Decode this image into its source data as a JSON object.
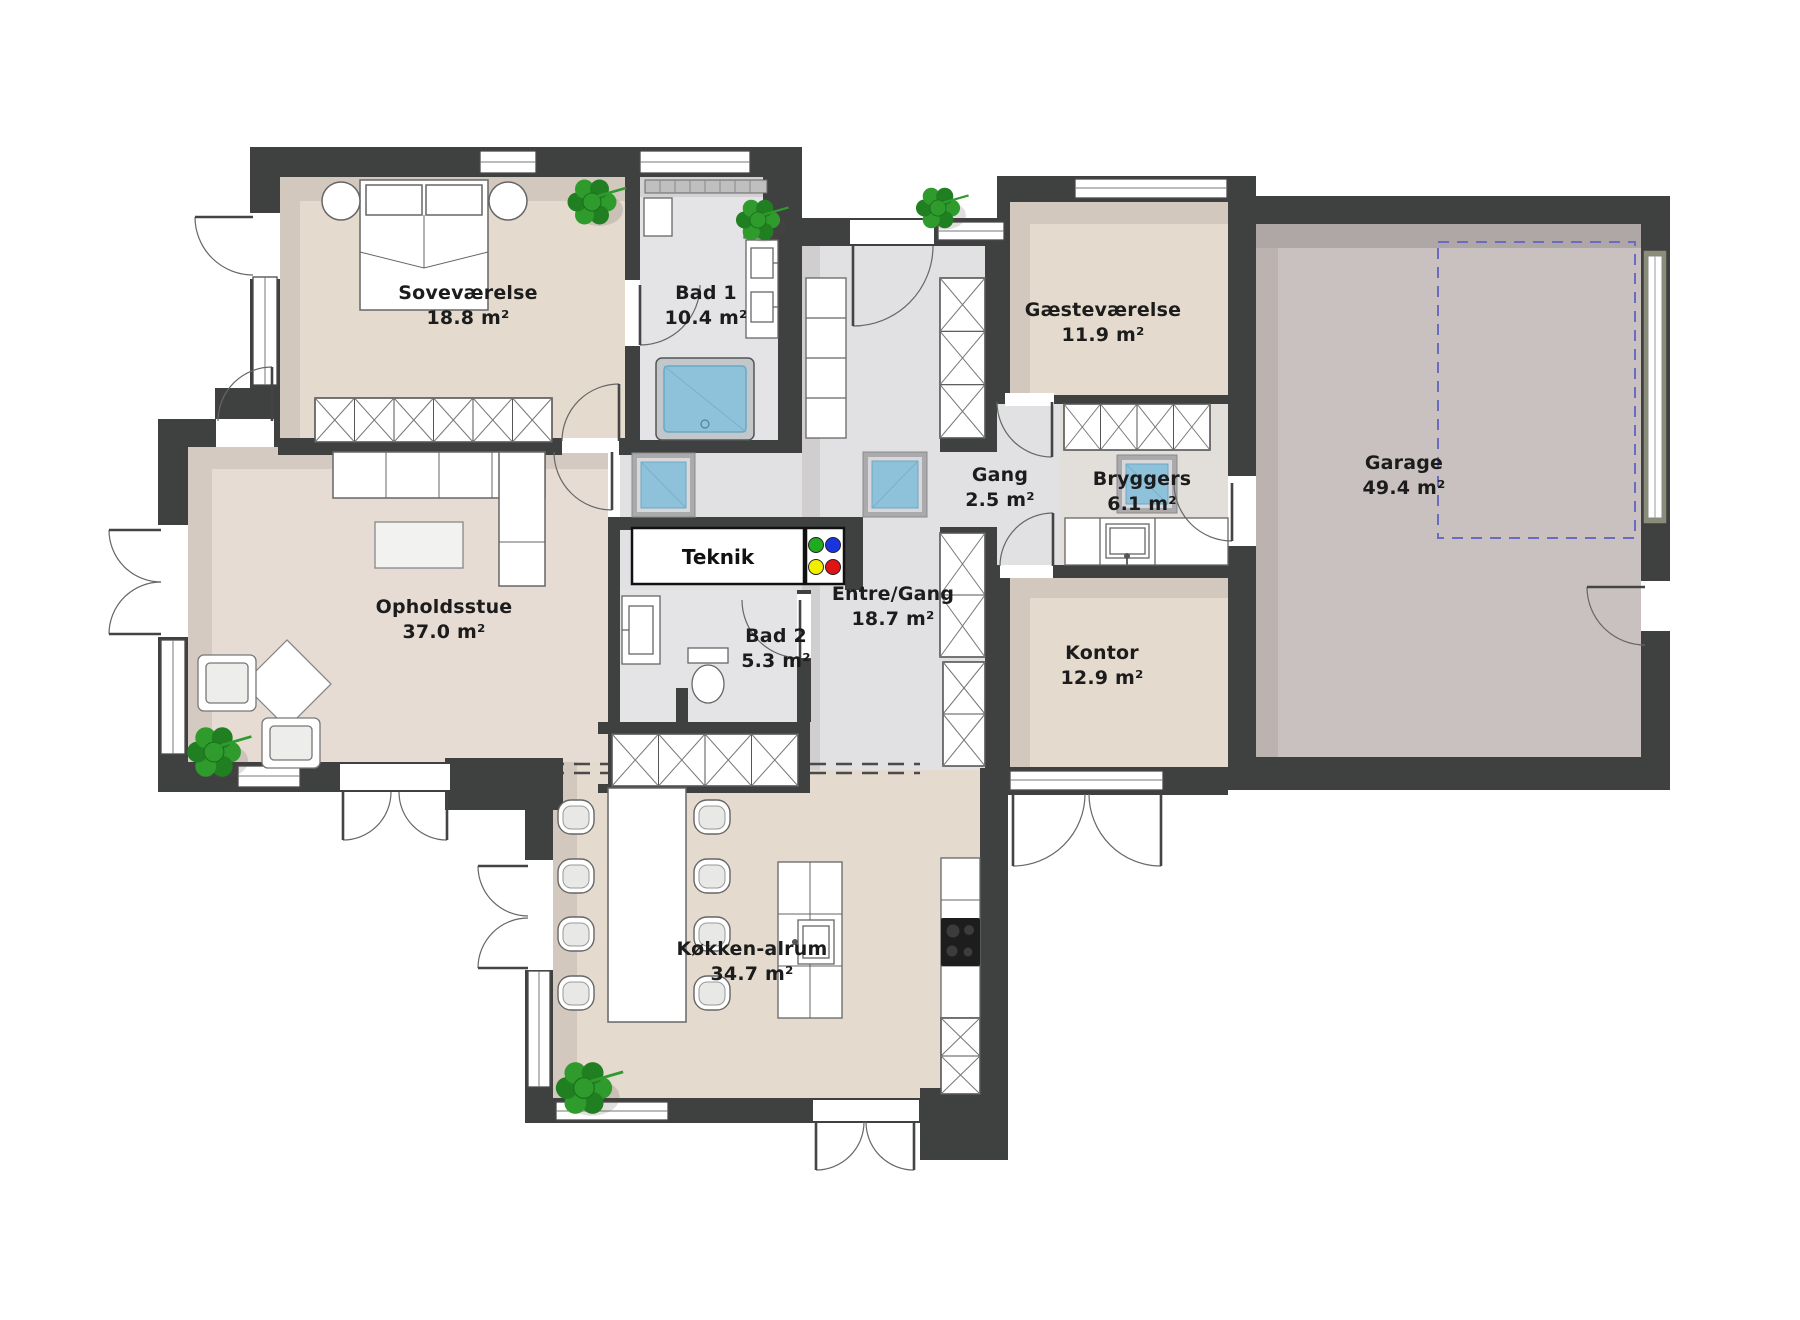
{
  "plan": {
    "title": "Floor plan",
    "rooms": [
      {
        "id": "sovevaerelse",
        "name": "Soveværelse",
        "area": "18.8 m²"
      },
      {
        "id": "bad1",
        "name": "Bad 1",
        "area": "10.4 m²"
      },
      {
        "id": "gaestevaerelse",
        "name": "Gæsteværelse",
        "area": "11.9 m²"
      },
      {
        "id": "gang",
        "name": "Gang",
        "area": "2.5 m²"
      },
      {
        "id": "bryggers",
        "name": "Bryggers",
        "area": "6.1 m²"
      },
      {
        "id": "garage",
        "name": "Garage",
        "area": "49.4 m²"
      },
      {
        "id": "opholdsstue",
        "name": "Opholdsstue",
        "area": "37.0 m²"
      },
      {
        "id": "teknik",
        "name": "Teknik",
        "area": ""
      },
      {
        "id": "bad2",
        "name": "Bad 2",
        "area": "5.3 m²"
      },
      {
        "id": "entre",
        "name": "Entre/Gang",
        "area": "18.7 m²"
      },
      {
        "id": "kontor",
        "name": "Kontor",
        "area": "12.9 m²"
      },
      {
        "id": "koekken",
        "name": "Køkken-alrum",
        "area": "34.7 m²"
      }
    ],
    "colors": {
      "wall": "#3f4040",
      "floor_beige": "#e4dace",
      "floor_living": "#e6dcd3",
      "floor_gray": "#e1e1e3",
      "floor_bath": "#e4e4e6",
      "floor_bryggers": "#e2dfda",
      "floor_garage": "#c9c1c0",
      "skylight_blue": "#8ec2db",
      "plant_green": "#2e9b2c",
      "garage_zone_dashed": "#6b6bc0",
      "teknik_dots": [
        "#1faa1f",
        "#1a35e0",
        "#f2ee00",
        "#e01414"
      ]
    }
  }
}
